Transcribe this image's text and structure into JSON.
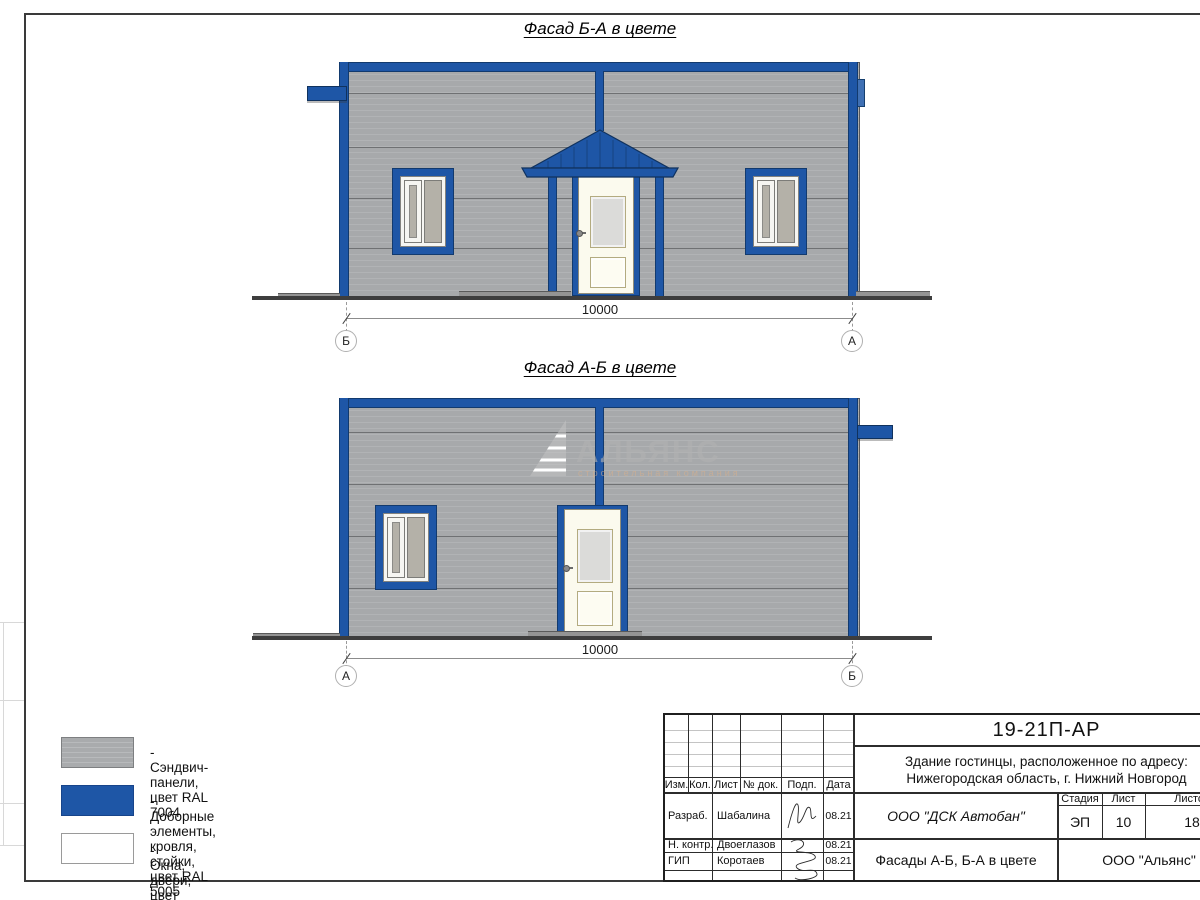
{
  "sheet": {
    "doc_type": "architectural facade drawing",
    "colors": {
      "panel_gray_ral7004": "#a7a9ab",
      "trim_blue_ral5005": "#1E56A6",
      "white_ral9003": "#ffffff"
    }
  },
  "facades": [
    {
      "title": "Фасад Б-А в цвете",
      "dimension": "10000",
      "axis_left": "Б",
      "axis_right": "А"
    },
    {
      "title": "Фасад А-Б в цвете",
      "dimension": "10000",
      "axis_left": "А",
      "axis_right": "Б"
    }
  ],
  "watermark": {
    "name": "АЛЬЯНС",
    "subtitle": "строительная компания"
  },
  "legend": [
    {
      "label": "- Сэндвич-панели, цвет RAL 7004",
      "color": "#a7a9ab"
    },
    {
      "label": "- Доборные элементы, кровля, стойки, цвет RAL 5005",
      "color": "#1E56A6"
    },
    {
      "label": "- Окна, двери, цвет RAL 9003",
      "color": "#ffffff"
    }
  ],
  "title_block": {
    "doc_number": "19-21П-АР",
    "address_line1": "Здание гостинцы, расположенное по адресу:",
    "address_line2": "Нижегородская область, г. Нижний Новгород",
    "columns": [
      "Изм.",
      "Кол.",
      "Лист",
      "№ док.",
      "Подп.",
      "Дата"
    ],
    "rows": [
      {
        "role": "Разраб.",
        "name": "Шабалина",
        "date": "08.21"
      },
      {
        "role": "Н. контр.",
        "name": "Двоеглазов",
        "date": "08.21"
      },
      {
        "role": "ГИП",
        "name": "Коротаев",
        "date": "08.21"
      }
    ],
    "company_top": "ООО \"ДСК Автобан\"",
    "stage_header": [
      "Стадия",
      "Лист",
      "Листов"
    ],
    "stage_values": [
      "ЭП",
      "10",
      "18"
    ],
    "sheet_title": "Фасады А-Б, Б-А в цвете",
    "company_bottom": "ООО \"Альянс\""
  }
}
